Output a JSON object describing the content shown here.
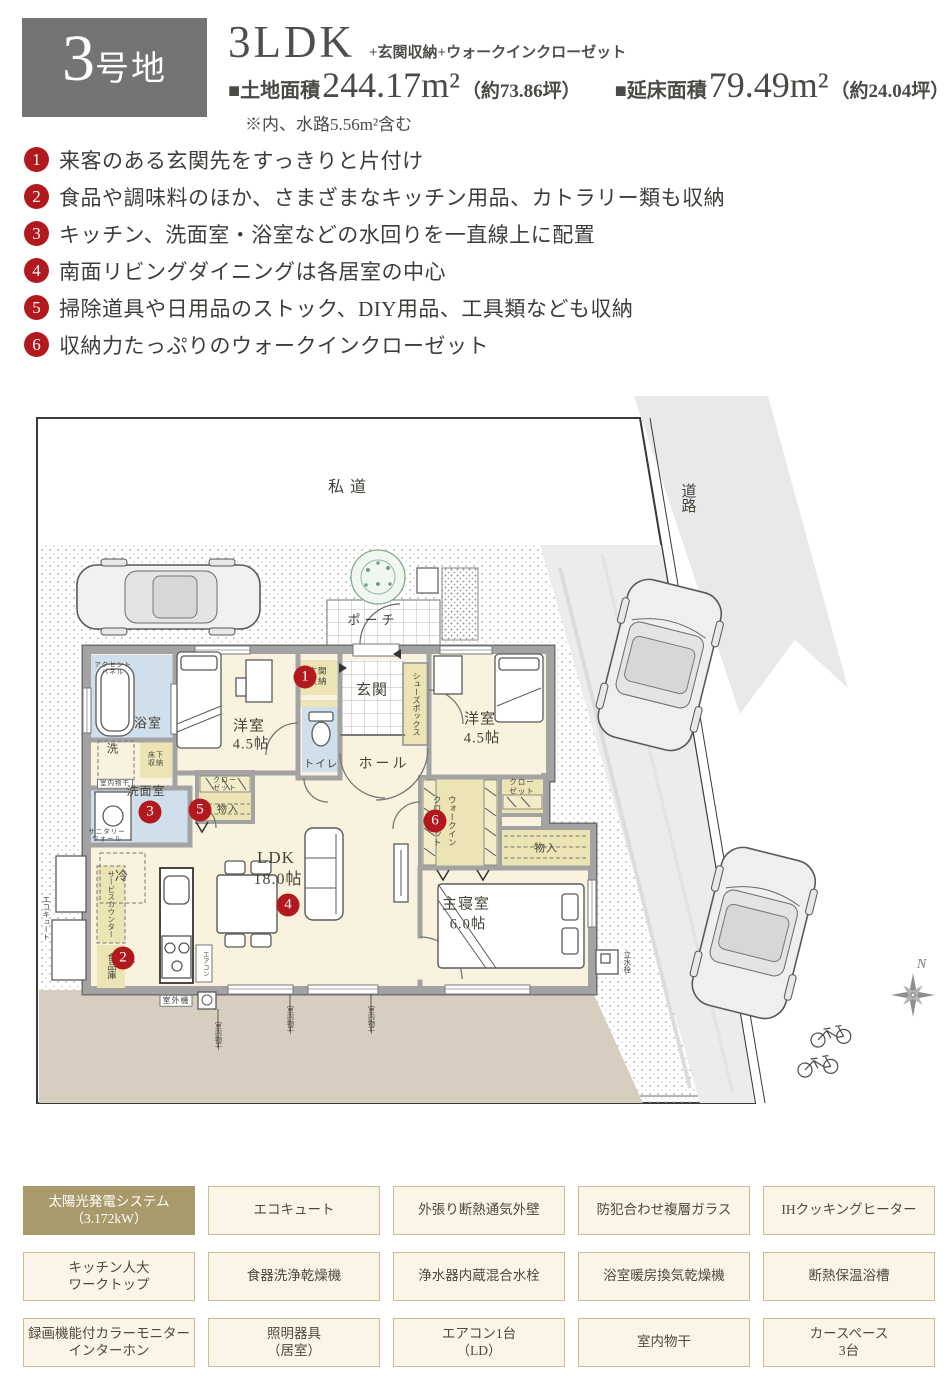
{
  "colors": {
    "accent_red": "#b2191f",
    "lot_badge_gray": "#757474",
    "badge_highlight": "#a99a6c",
    "badge_bg": "#faf5e6",
    "badge_border": "#c9bd98",
    "room_cream": "#f8f2de",
    "wet_room_blue": "#cfdfeb",
    "storage_khaki": "#ece4b4",
    "garden_tan": "#d8cec0"
  },
  "header": {
    "lot_number": "3",
    "lot_suffix": "号地",
    "plan_type": "3LDK",
    "plan_extra": "+玄関収納+ウォークインクローゼット",
    "land_label": "■土地面積",
    "land_value": "244.17m²",
    "land_paren": "（約73.86坪）",
    "floor_label": "■延床面積",
    "floor_value": "79.49m²",
    "floor_paren": "（約24.04坪）",
    "note": "※内、水路5.56m²含む"
  },
  "features": [
    {
      "num": "1",
      "text": "来客のある玄関先をすっきりと片付け"
    },
    {
      "num": "2",
      "text": "食品や調味料のほか、さまざまなキッチン用品、カトラリー類も収納"
    },
    {
      "num": "3",
      "text": "キッチン、洗面室・浴室などの水回りを一直線上に配置"
    },
    {
      "num": "4",
      "text": "南面リビングダイニングは各居室の中心"
    },
    {
      "num": "5",
      "text": "掃除道具や日用品のストック、DIY用品、工具類なども収納"
    },
    {
      "num": "6",
      "text": "収納力たっぷりのウォークインクローゼット"
    }
  ],
  "plan": {
    "labels": {
      "shido": "私道",
      "doro": "道路",
      "porch": "ポーチ",
      "genkan": "玄関",
      "hall": "ホール",
      "toilet": "トイレ",
      "shoes_box": "シューズボックス",
      "genkan_storage": "玄関\n収納",
      "bath": "浴室",
      "wash": "洗",
      "indoor_hanger": "室内物干",
      "underfloor": "床下\n収納",
      "senmen": "洗面室",
      "sanitary_wall": "サニタリー\nウォール",
      "accent_panel": "アクセント\nパネル",
      "fridge": "冷",
      "service_counter": "サービスカウンター",
      "pantry": "食品庫",
      "ecocute": "エコキュート",
      "yoshitsu1_name": "洋室",
      "yoshitsu1_size": "4.5帖",
      "yoshitsu2_name": "洋室",
      "yoshitsu2_size": "4.5帖",
      "ldk_name": "LDK",
      "ldk_size": "18.0帖",
      "master_name": "主寝室",
      "master_size": "6.0帖",
      "wic_line1": "ウォークイン",
      "wic_line2": "クローゼット",
      "closet_r": "クロー\nゼット",
      "storage_r": "物入",
      "closet_l": "クロー\nゼット",
      "storage_l": "物入",
      "aircon": "エアコン",
      "outdoor_unit": "室外機",
      "outdoor_hanger": "室内物干",
      "tap": "立水栓",
      "compass_n": "N"
    }
  },
  "badges": {
    "items": [
      {
        "label": "太陽光発電システム\n（3.172kW）",
        "highlight": true
      },
      {
        "label": "エコキュート"
      },
      {
        "label": "外張り断熱通気外壁"
      },
      {
        "label": "防犯合わせ複層ガラス"
      },
      {
        "label": "IHクッキングヒーター"
      },
      {
        "label": "キッチン人大\nワークトップ"
      },
      {
        "label": "食器洗浄乾燥機"
      },
      {
        "label": "浄水器内蔵混合水栓"
      },
      {
        "label": "浴室暖房換気乾燥機"
      },
      {
        "label": "断熱保温浴槽"
      },
      {
        "label": "録画機能付カラーモニター\nインターホン"
      },
      {
        "label": "照明器具\n（居室）"
      },
      {
        "label": "エアコン1台\n（LD）"
      },
      {
        "label": "室内物干"
      },
      {
        "label": "カースペース\n3台"
      }
    ]
  }
}
